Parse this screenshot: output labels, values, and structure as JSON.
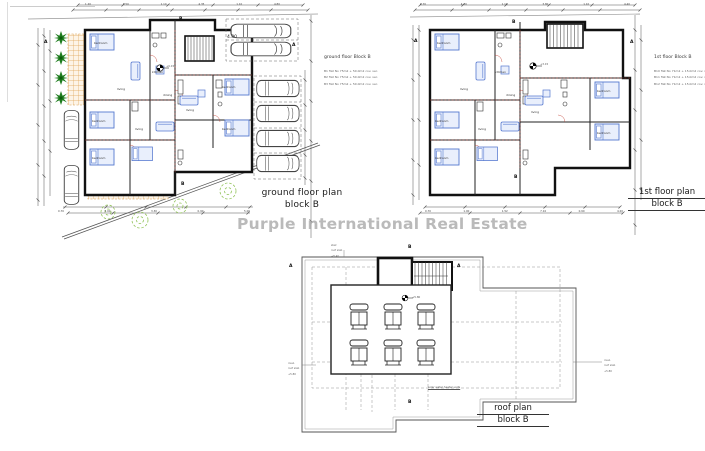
{
  "watermark": {
    "text": "Purple International Real Estate"
  },
  "rooms": {
    "bedroom": "bedroom",
    "living": "living",
    "kitchen": "kitchen",
    "dining": "dining"
  },
  "markers": {
    "a": "A",
    "b": "B"
  },
  "ground_floor": {
    "title_line1": "ground floor plan",
    "title_line2": "block B",
    "note_title": "ground floor Block B",
    "note_lines": [
      "B1 flat No 75m2 + 50.0m2 cov. ver.",
      "B2 flat No 75m2 + 50.0m2 cov. ver.",
      "B3 flat No 75m2 + 50.0m2 cov. ver."
    ],
    "parking_dim": "4.80",
    "level": "+0.15",
    "dims_top": [
      "1.20",
      "3.50",
      "1.10",
      "4.35",
      "1.10",
      "4.80"
    ],
    "dims_bottom": [
      "0.70",
      "5.00",
      "3.30",
      "0.90",
      "5.00"
    ]
  },
  "first_floor": {
    "title_line1": "1st floor plan",
    "title_line2": "block B",
    "note_title": "1st floor Block B",
    "note_lines": [
      "B10 flat No 71m2 + 15.0m2 cov. ver.",
      "B11 flat No 71m2 + 15.0m2 cov. ver.",
      "B12 flat No 71m2 + 15.0m2 cov. ver."
    ],
    "level": "+3.15",
    "dims_top": [
      "0.70",
      "4.20",
      "1.10",
      "3.80",
      "1.10",
      "4.40"
    ],
    "dims_bottom": [
      "0.70",
      "1.00",
      "1.52",
      "7.10",
      "0.90",
      "4.20"
    ]
  },
  "roof": {
    "title_line1": "roof plan",
    "title_line2": "block B",
    "unit_note": "solar water heater units",
    "note_left": [
      "insul.",
      "roof slab",
      "+5.80"
    ],
    "note_right": [
      "insul.",
      "roof slab",
      "+5.80"
    ],
    "note_top": [
      "stair",
      "roof slab",
      "+8.40"
    ],
    "level": "+5.80"
  }
}
